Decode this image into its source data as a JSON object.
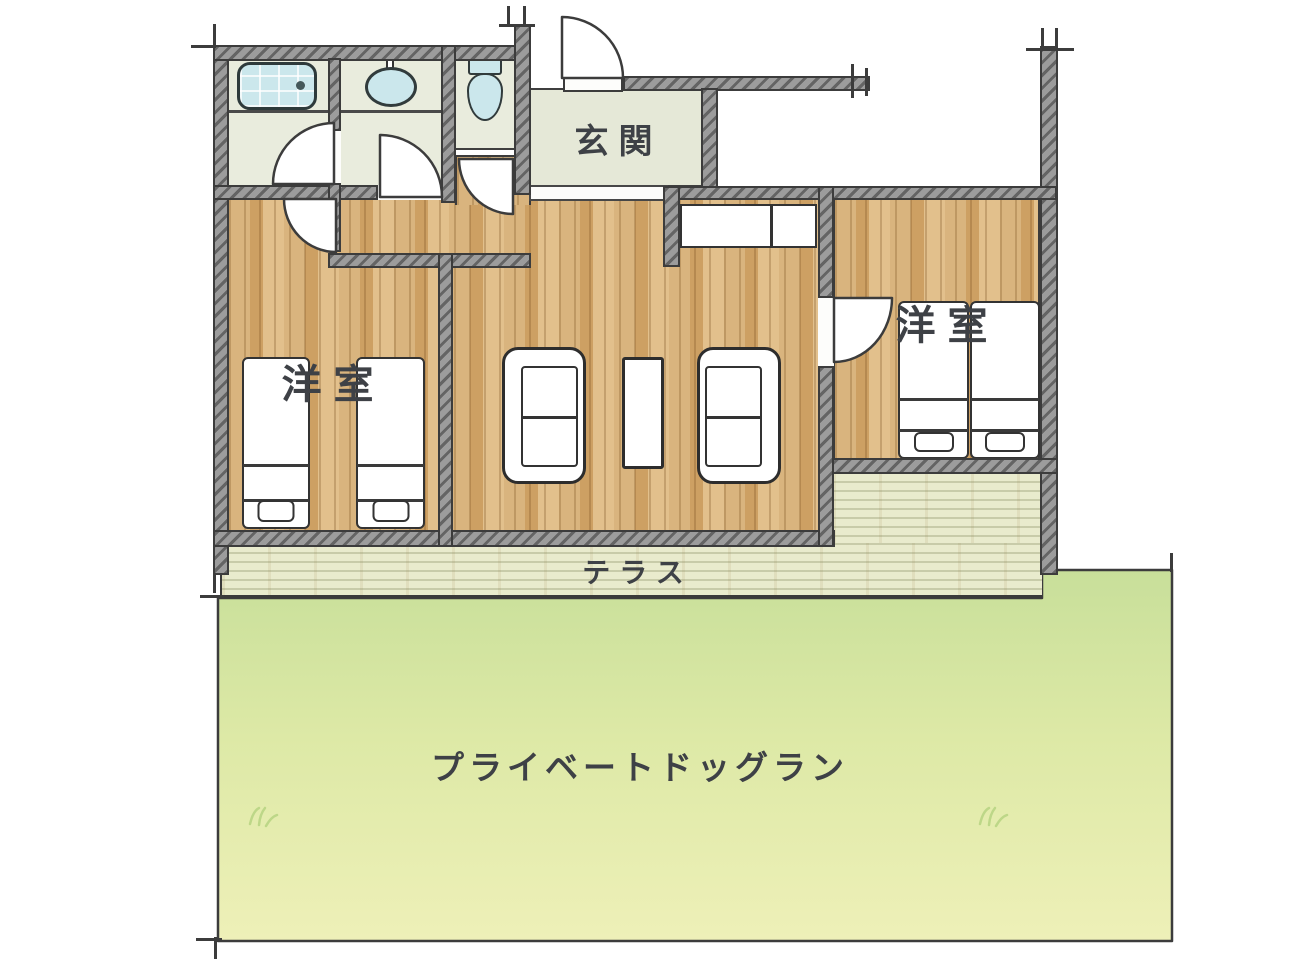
{
  "diagram": {
    "type": "floor-plan",
    "labels": {
      "entrance": "玄関",
      "bedroom_left": "洋室",
      "bedroom_right": "洋室",
      "terrace": "テラス",
      "dog_run": "プライベートドッグラン"
    },
    "colors": {
      "wall": "#9c9c9c",
      "wall_line": "#3c3c3c",
      "wood": "#d5ad74",
      "pale_floor": "#e9ecdd",
      "entrance_floor": "#e5e8d7",
      "fixture_blue": "#cbe7ec",
      "terrace": "#e9ebcd",
      "dog_run_top": "#c8df9a",
      "dog_run_mid": "#dde9a6",
      "dog_run_bottom": "#eef0b8",
      "ink": "#3e4146"
    }
  }
}
